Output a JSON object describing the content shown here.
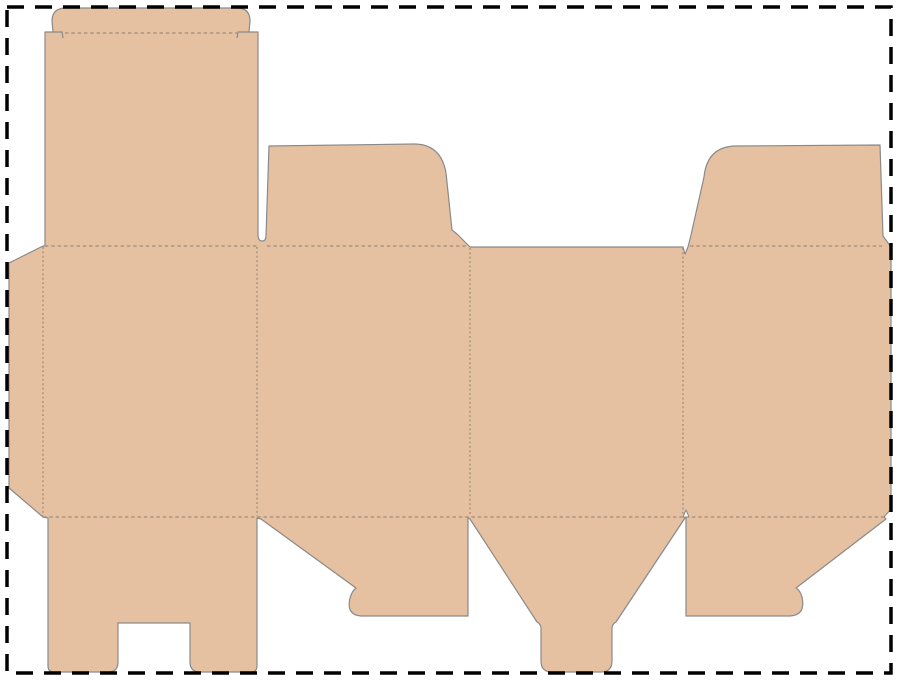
{
  "canvas": {
    "width": 900,
    "height": 681,
    "background": "#ffffff"
  },
  "dieline": {
    "kind": "box-packaging-dieline-template",
    "material_color": "#e5c1a1",
    "cut_line_color": "#8a8a8a",
    "cut_line_width": 1.2,
    "fold_line_color": "#8f8070",
    "border": {
      "x": 7,
      "y": 7,
      "width": 884,
      "height": 666,
      "color": "#000000",
      "stroke_width": 3.5,
      "dash": "17 11"
    },
    "outline_path": "M 66,8 L 237,8 Q 250,8 250,21 L 249,32 L 258,32 L 258,234 Q 258,241 262,241 Q 266,241 266,236 L 269,146 L 414,144 Q 441,144 446,173 L 452,230 L 457,234 L 468,245 L 470,247 L 683,247 L 685,254 L 688,247 L 691,235 L 704,177 Q 707,147 735,146 L 880,145 L 883,236 L 891,247 L 891,509 L 884,517 L 886,519 L 796,588 Q 800,590 802,597 Q 806,615 790,616 L 686,616 L 686,518 L 685,518 L 616,622 Q 612,624 612,629 L 612,661 Q 612,672 601,672 L 552,672 Q 541,672 541,661 L 541,629 Q 541,624 537,622 L 470,519 L 468,518 L 468,616 L 361,616 Q 346,615 350,598 Q 352,591 356,588 L 261,519 L 257,518 L 257,666 Q 257,672 251,672 L 200,672 Q 190,672 190,662 L 190,623 L 118,623 L 118,662 Q 118,672 108,672 L 54,672 Q 48,672 48,666 L 48,518 L 43,517 L 9,488 L 9,263 L 43,246 L 45,246 L 45,32 L 53,32 L 52,21 Q 52,8 66,8 Z",
    "cut_marks": [
      "M 53,32 L 62,32 L 63,38",
      "M 250,32 L 238,32 L 237,38"
    ],
    "relief_notches": [
      "M 683,517 L 686,510 L 689,517 Z"
    ],
    "fold_lines": {
      "horizontal_dash": "3.5 2.8",
      "vertical_dash": "1.8 2.6",
      "horizontal": [
        {
          "name": "tuck-flap-fold",
          "x1": 65,
          "y1": 33,
          "x2": 237,
          "y2": 33
        },
        {
          "name": "lid-top-fold",
          "x1": 45,
          "y1": 246,
          "x2": 257,
          "y2": 246
        },
        {
          "name": "dust-flap-left-fold",
          "x1": 267,
          "y1": 246,
          "x2": 468,
          "y2": 246
        },
        {
          "name": "dust-flap-right-fold",
          "x1": 690,
          "y1": 246,
          "x2": 882,
          "y2": 246
        },
        {
          "name": "bottom-fold",
          "x1": 43,
          "y1": 517,
          "x2": 886,
          "y2": 517
        }
      ],
      "vertical": [
        {
          "name": "glue-flap-fold",
          "x1": 43,
          "y1": 247,
          "x2": 43,
          "y2": 516
        },
        {
          "name": "panel-1-2-fold",
          "x1": 257,
          "y1": 247,
          "x2": 257,
          "y2": 516
        },
        {
          "name": "panel-2-3-fold",
          "x1": 470,
          "y1": 248,
          "x2": 470,
          "y2": 516
        },
        {
          "name": "panel-3-4-fold",
          "x1": 683,
          "y1": 248,
          "x2": 683,
          "y2": 516
        }
      ]
    }
  }
}
